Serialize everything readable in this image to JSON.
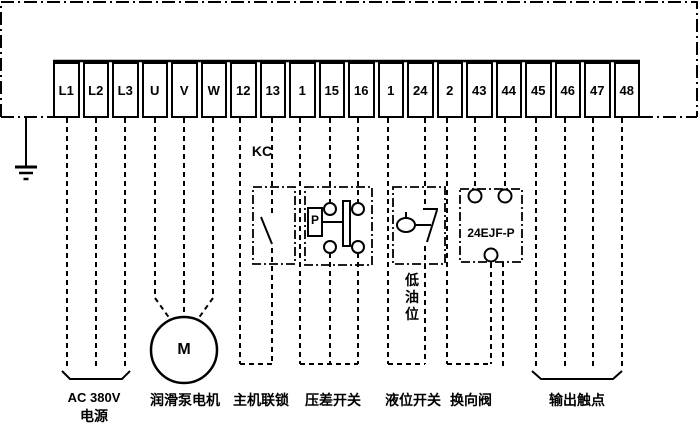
{
  "diagram": {
    "terminals": [
      "L1",
      "L2",
      "L3",
      "U",
      "V",
      "W",
      "12",
      "13",
      "1",
      "15",
      "16",
      "1",
      "24",
      "2",
      "43",
      "44",
      "45",
      "46",
      "47",
      "48"
    ],
    "labels": {
      "relay_contact": "KC",
      "pressure_sensor": "P",
      "valve_model": "24EJF-P",
      "low_oil_level": "低油位",
      "motor_letter": "M",
      "power_caption_line1": "AC 380V",
      "power_caption_line2": "电源",
      "motor_caption": "润滑泵电机",
      "interlock_caption": "主机联锁",
      "pressure_caption": "压差开关",
      "level_caption": "液位开关",
      "valve_caption": "换向阀",
      "output_caption": "输出触点"
    },
    "colors": {
      "line": "#000000",
      "background": "#ffffff"
    }
  }
}
